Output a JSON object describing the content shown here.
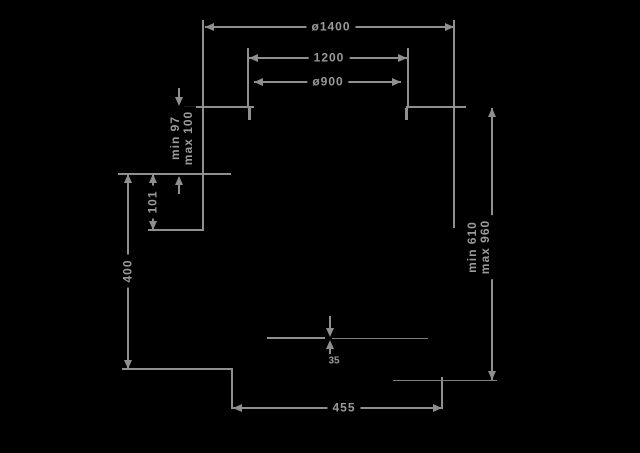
{
  "diagram": {
    "background": "#000000",
    "line_color": "#8f8f8f",
    "text_color": "#9a9a9a",
    "labels": {
      "outer_diameter": "ø1400",
      "suspension_width": "1200",
      "inner_diameter": "ø900",
      "ceiling_clearance_line1": "min 97",
      "ceiling_clearance_line2": "max 100",
      "bracket_offset": "101",
      "wall_offset": "400",
      "drop_range_line1": "min 610",
      "drop_range_line2": "max 960",
      "base_width": "455",
      "disc_thickness": "35"
    }
  }
}
